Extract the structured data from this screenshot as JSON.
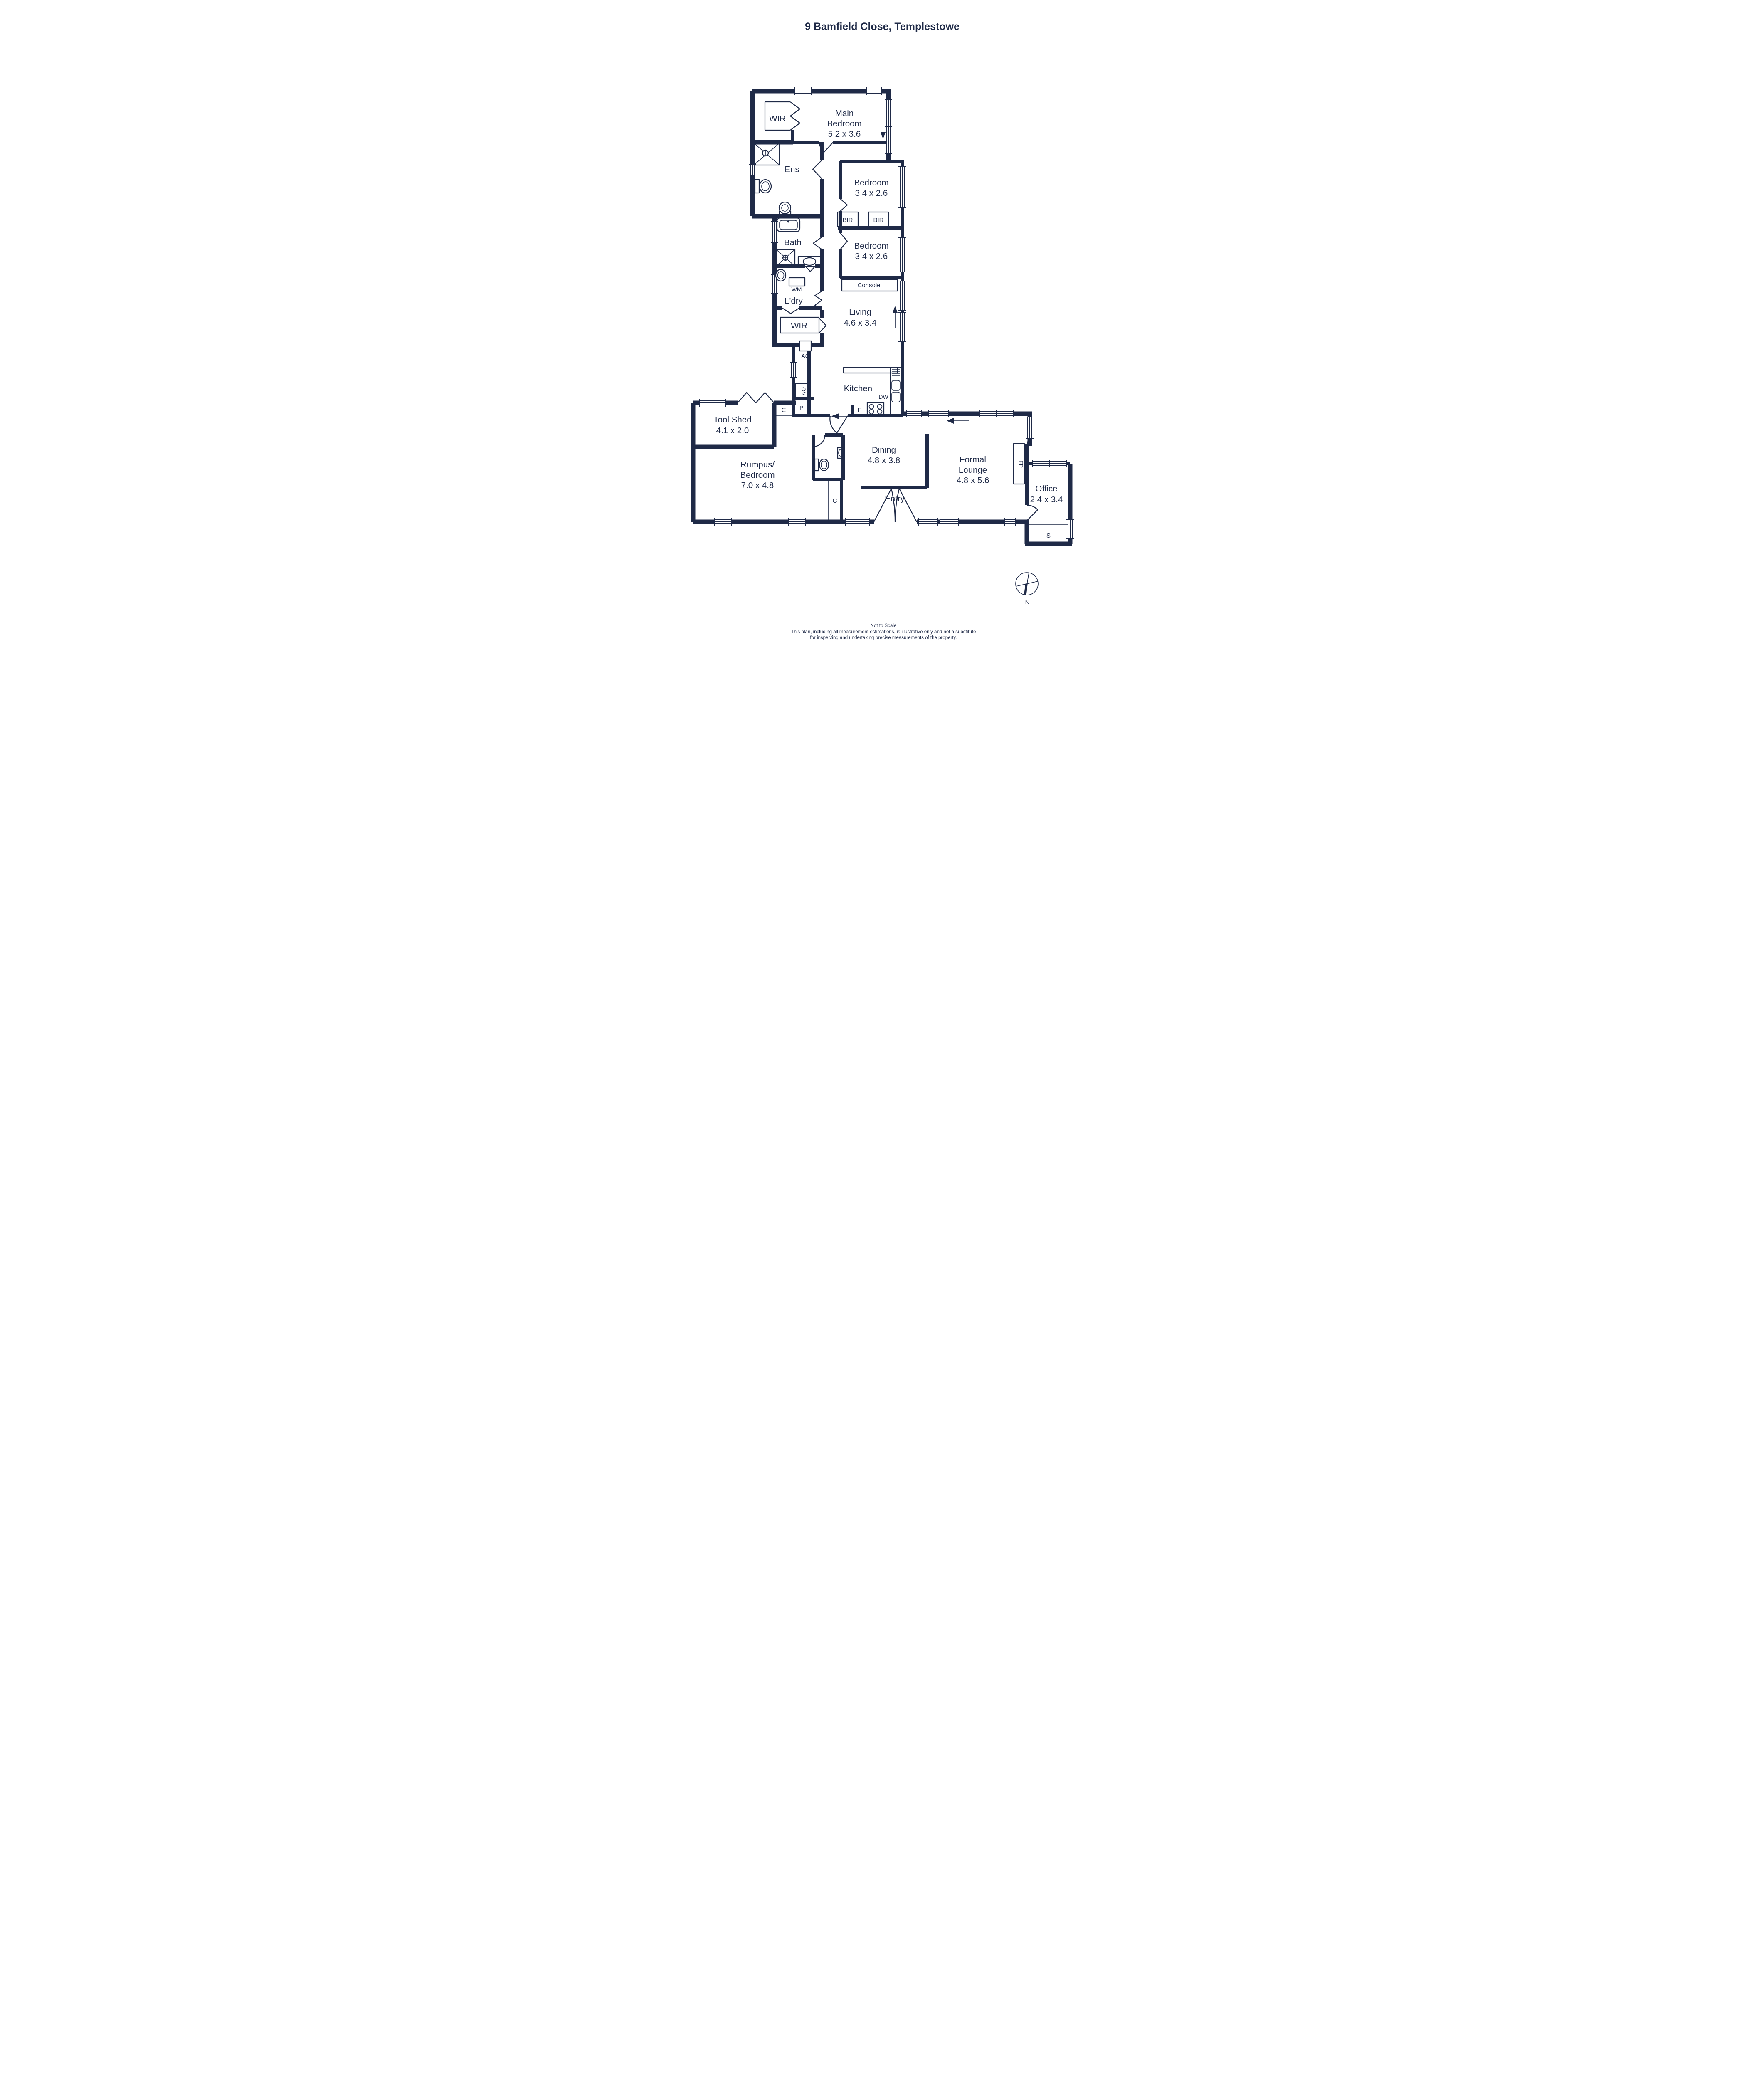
{
  "title": "9 Bamfield Close, Templestowe",
  "colors": {
    "ink": "#1f2a47",
    "bg": "#ffffff"
  },
  "rooms": {
    "wir_main": {
      "label": "WIR"
    },
    "main_bedroom": {
      "name_line1": "Main",
      "name_line2": "Bedroom",
      "dims": "5.2 x 3.6"
    },
    "ens": {
      "label": "Ens"
    },
    "bedroom_upper": {
      "name": "Bedroom",
      "dims": "3.4 x 2.6"
    },
    "bir_left": {
      "label": "BIR"
    },
    "bir_right": {
      "label": "BIR"
    },
    "bath": {
      "label": "Bath"
    },
    "bedroom_lower": {
      "name": "Bedroom",
      "dims": "3.4 x 2.6"
    },
    "console": {
      "label": "Console"
    },
    "wm": {
      "label": "WM"
    },
    "laundry": {
      "label": "L'dry"
    },
    "living": {
      "name": "Living",
      "dims": "4.6 x 3.4"
    },
    "wir_hall": {
      "label": "WIR"
    },
    "ac": {
      "label": "AC"
    },
    "oven": {
      "label": "OV"
    },
    "pantry": {
      "label": "P"
    },
    "cupboard_hall": {
      "label": "C"
    },
    "kitchen": {
      "label": "Kitchen"
    },
    "dishwasher": {
      "label": "DW"
    },
    "fridge": {
      "label": "F"
    },
    "tool_shed": {
      "name": "Tool Shed",
      "dims": "4.1 x 2.0"
    },
    "rumpus": {
      "name_line1": "Rumpus/",
      "name_line2": "Bedroom",
      "dims": "7.0 x 4.8"
    },
    "dining": {
      "name": "Dining",
      "dims": "4.8 x 3.8"
    },
    "formal_lounge": {
      "name_line1": "Formal",
      "name_line2": "Lounge",
      "dims": "4.8 x 5.6"
    },
    "fireplace": {
      "label": "FP"
    },
    "office": {
      "name": "Office",
      "dims": "2.4 x 3.4"
    },
    "entry": {
      "label": "Entry"
    },
    "cupboard_rumpus": {
      "label": "C"
    },
    "store": {
      "label": "S"
    }
  },
  "compass": {
    "north_label": "N"
  },
  "footer": {
    "line1": "Not to Scale",
    "line2": "This plan, including all measurement estimations, is illustrative only and not a substitute",
    "line3": "for inspecting and undertaking precise measurements of the property."
  }
}
